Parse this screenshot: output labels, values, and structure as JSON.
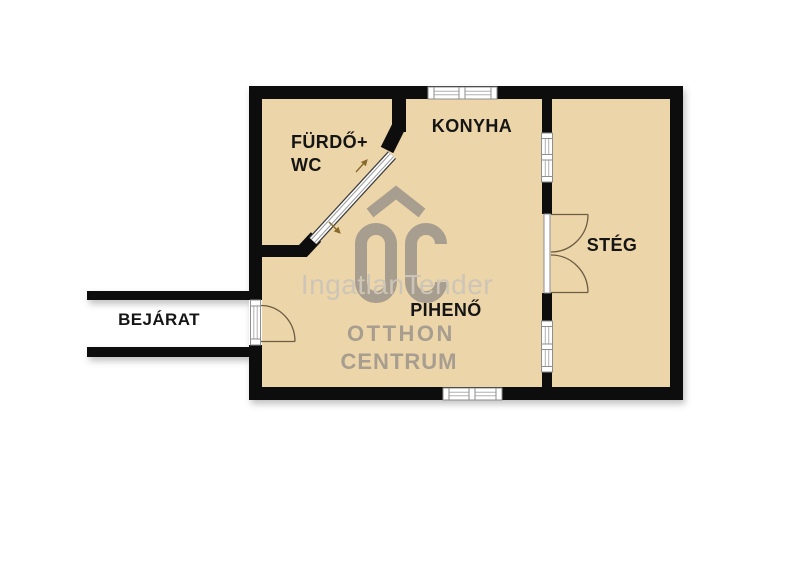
{
  "plan_title": "floor-plan",
  "rooms": {
    "bathroom": {
      "label_line1": "FÜRDŐ+",
      "label_line2": "WC"
    },
    "kitchen": {
      "label": "KONYHA"
    },
    "lounge": {
      "label": "PIHENŐ"
    },
    "deck": {
      "label": "STÉG"
    },
    "entrance": {
      "label": "BEJÁRAT"
    }
  },
  "watermark": {
    "overlay_text": "IngatlanTender",
    "brand_line1": "OTTHON",
    "brand_line2": "CENTRUM",
    "logo_icon": "oc-house-logo-icon"
  },
  "colors": {
    "floor_fill": "#ecd6a9",
    "wall": "#0d0d0d",
    "watermark_gray": "#a89e90",
    "watermark_overlay_gray": "#cdc5b7",
    "door_arc": "#6b5c44",
    "slide_arrow": "#8a6a2a",
    "label_text": "#151515",
    "window_frame": "#8e8e8e",
    "background": "#ffffff"
  }
}
